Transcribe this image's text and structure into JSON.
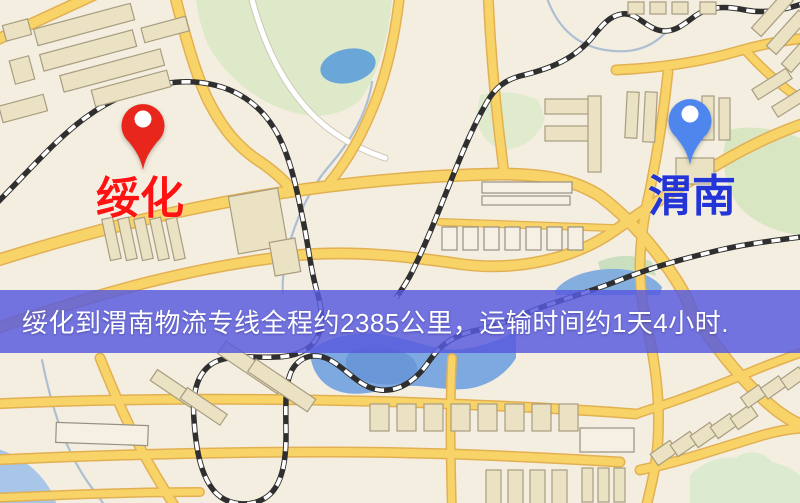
{
  "banner": {
    "text": "绥化到渭南物流专线全程约2385公里，运输时间约1天4小时.",
    "distance_text": "约2385公里",
    "duration_text": "约1天4小时",
    "background_color": "#5a5ade",
    "text_color": "#ffffff"
  },
  "markers": {
    "origin": {
      "label": "绥化",
      "pin_color": "#e8261b",
      "label_color": "#ff1212"
    },
    "destination": {
      "label": "渭南",
      "pin_color": "#4e86ee",
      "label_color": "#2335d6"
    }
  },
  "map_colors": {
    "land": "#f4eee0",
    "road": "#f8d468",
    "road_casing": "#e2b053",
    "minor_road": "#ffffff",
    "building": "#ebe1c3",
    "park_green": "#dde9c8",
    "water": "#6ba6d9",
    "railway": "#2f2f2f"
  }
}
